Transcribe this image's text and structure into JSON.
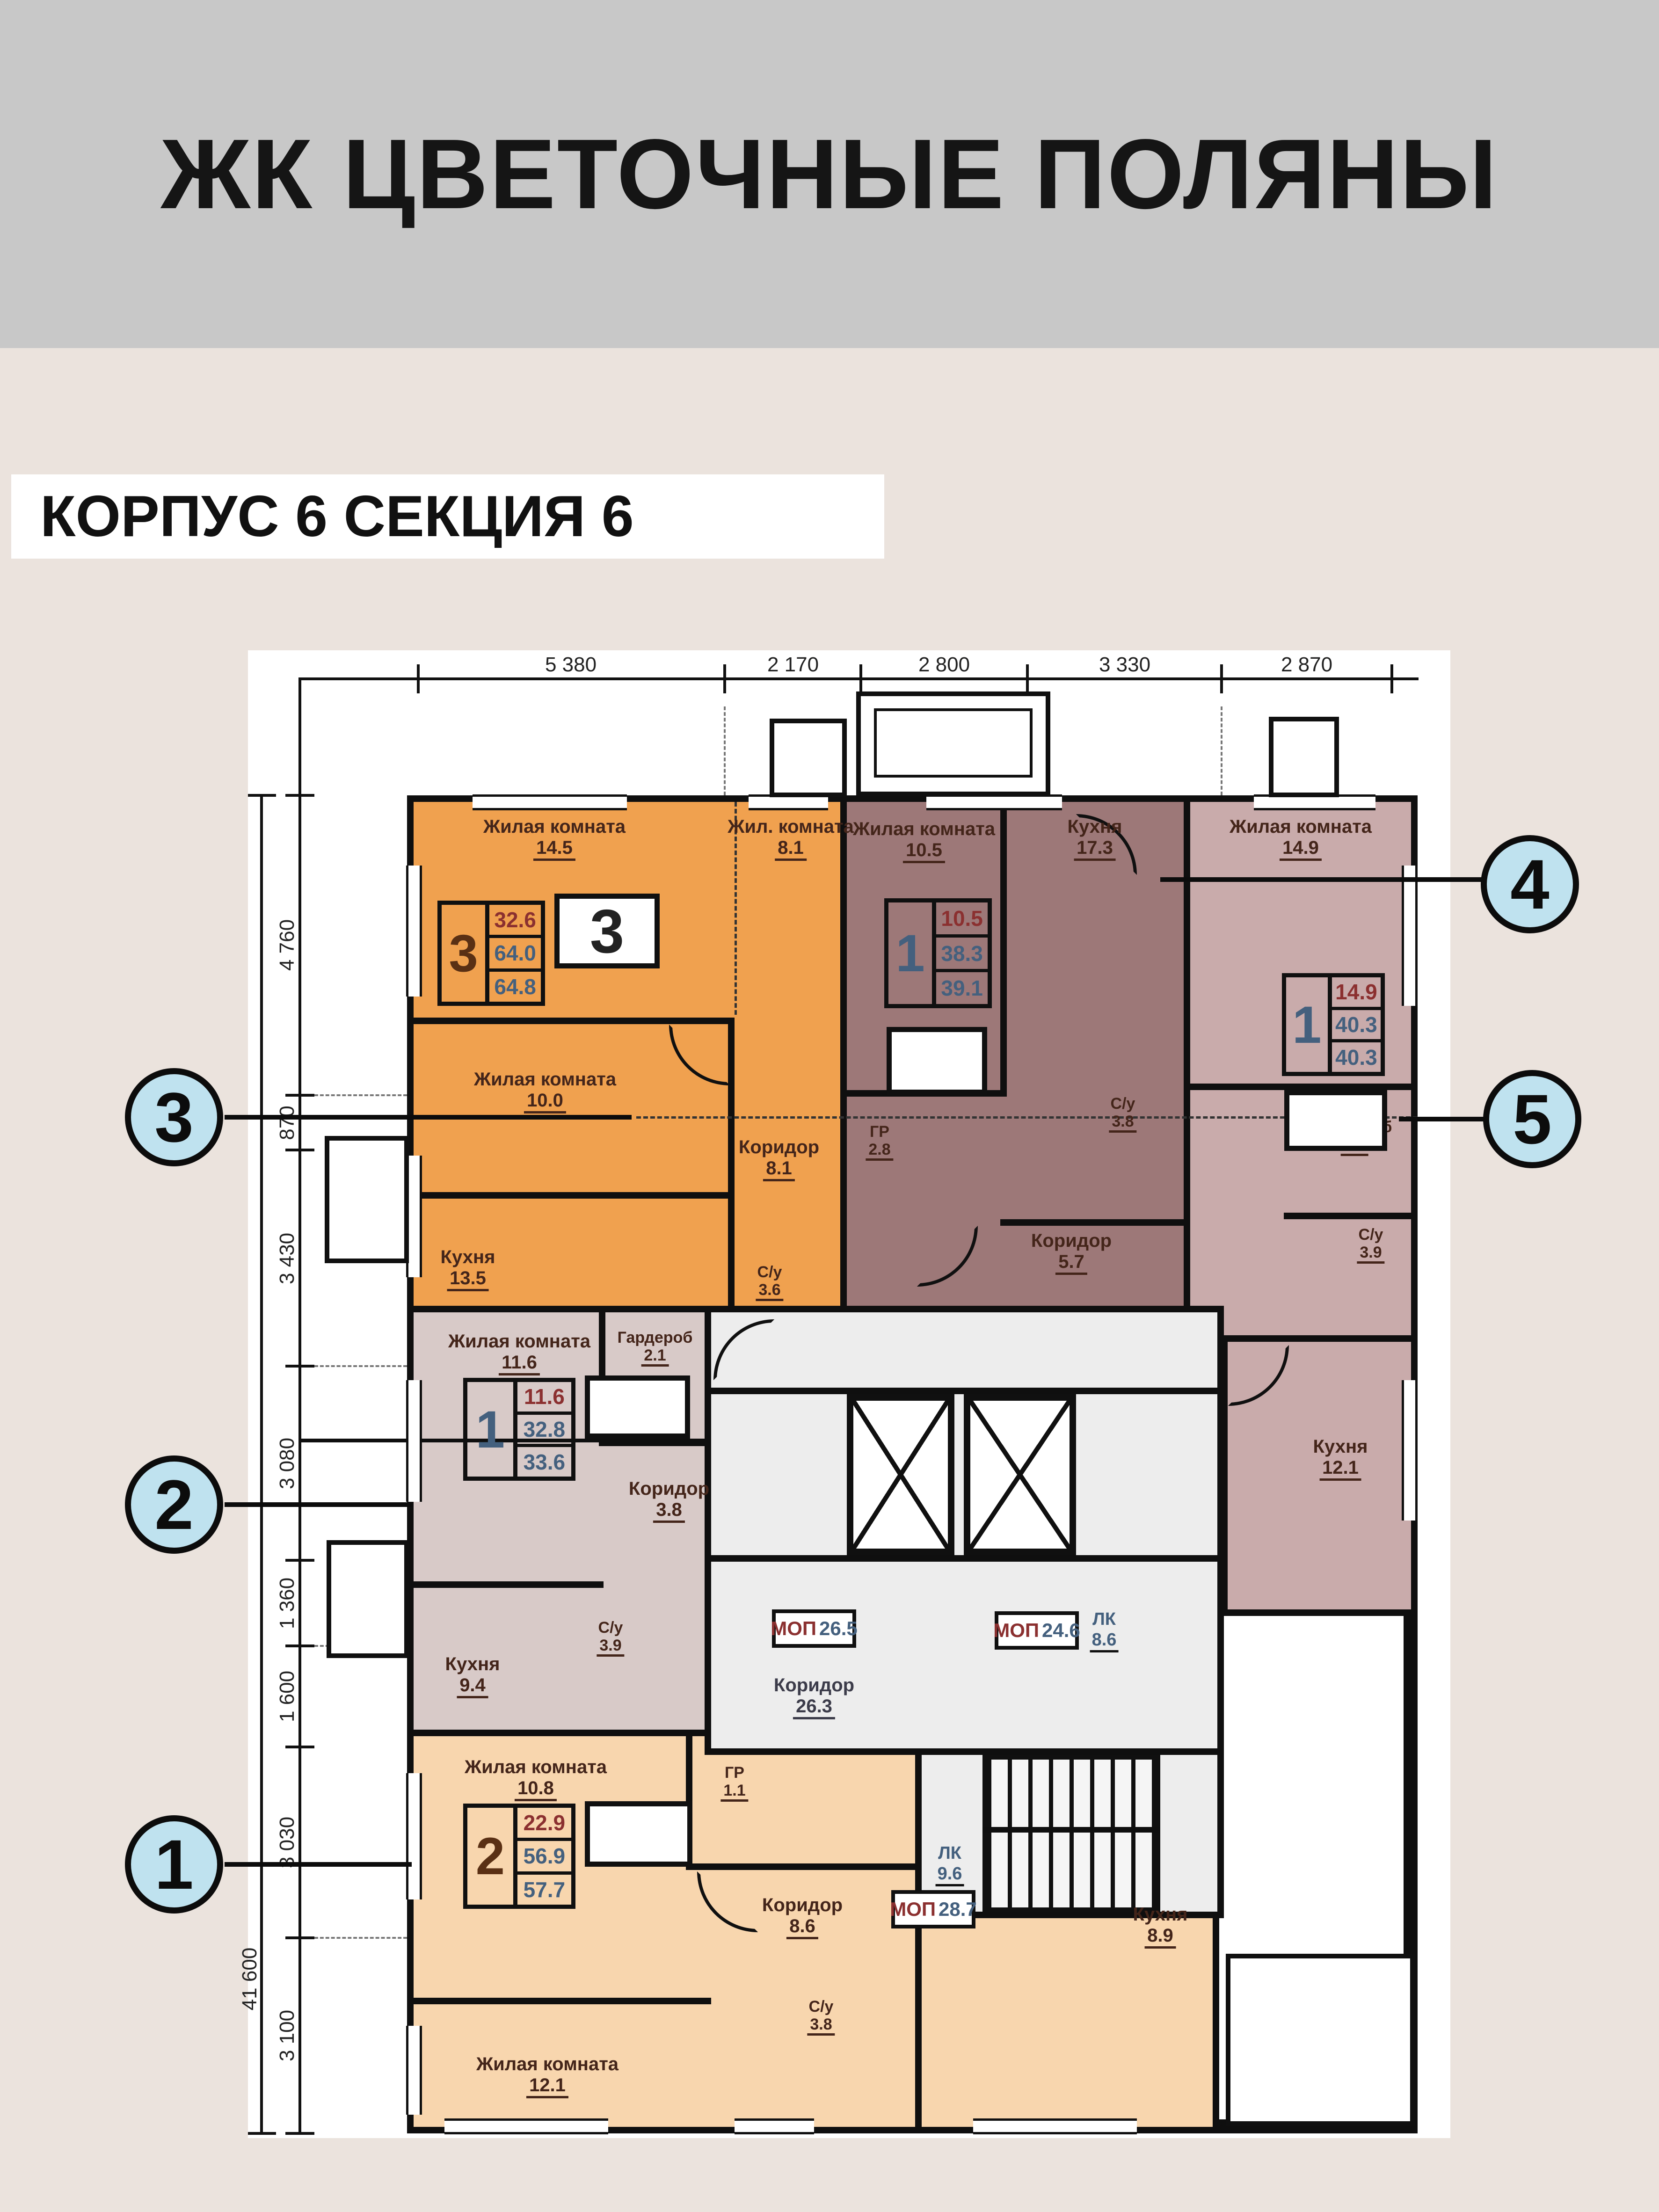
{
  "header": {
    "title": "ЖК ЦВЕТОЧНЫЕ ПОЛЯНЫ",
    "subtitle": "КОРПУС 6 СЕКЦИЯ 6"
  },
  "colors": {
    "header_bg": "#c8c8c8",
    "page_bg": "#ebe3dd",
    "callout_fill": "#bfe2ef",
    "apartment_3": "#f0a14f",
    "apartment_4": "#9d7878",
    "apartment_5": "#c9abab",
    "apartment_2": "#d8cac8",
    "apartment_1": "#f8d6ae",
    "common_area": "#ededed"
  },
  "callouts": [
    "1",
    "2",
    "3",
    "4",
    "5"
  ],
  "apartments": [
    {
      "callout": "3",
      "rooms_count": "3",
      "plate_number": "3",
      "areas": {
        "living": "32.6",
        "area": "64.0",
        "total": "64.8"
      },
      "rooms": [
        {
          "name": "Жилая комната",
          "area": "14.5"
        },
        {
          "name": "Жил. комната",
          "area": "8.1"
        },
        {
          "name": "Жилая комната",
          "area": "10.0"
        },
        {
          "name": "Кухня",
          "area": "13.5"
        },
        {
          "name": "Коридор",
          "area": "8.1"
        },
        {
          "name": "С/у",
          "area": "3.6"
        }
      ]
    },
    {
      "callout": "4",
      "rooms_count": "1",
      "plate_number": "",
      "areas": {
        "living": "10.5",
        "area": "38.3",
        "total": "39.1"
      },
      "rooms": [
        {
          "name": "Жилая комната",
          "area": "10.5"
        },
        {
          "name": "Кухня",
          "area": "17.3"
        },
        {
          "name": "ГР",
          "area": "2.8"
        },
        {
          "name": "Коридор",
          "area": "5.7"
        },
        {
          "name": "С/у",
          "area": "3.8"
        }
      ]
    },
    {
      "callout": "5",
      "rooms_count": "1",
      "plate_number": "",
      "areas": {
        "living": "14.9",
        "area": "40.3",
        "total": "40.3"
      },
      "rooms": [
        {
          "name": "Жилая комната",
          "area": "14.9"
        },
        {
          "name": "Гардероб",
          "area": "1.9"
        },
        {
          "name": "С/у",
          "area": "3.9"
        },
        {
          "name": "Кухня",
          "area": "12.1"
        }
      ]
    },
    {
      "callout": "2",
      "rooms_count": "1",
      "plate_number": "",
      "areas": {
        "living": "11.6",
        "area": "32.8",
        "total": "33.6"
      },
      "rooms": [
        {
          "name": "Жилая комната",
          "area": "11.6"
        },
        {
          "name": "Гардероб",
          "area": "2.1"
        },
        {
          "name": "Коридор",
          "area": "3.8"
        },
        {
          "name": "С/у",
          "area": "3.9"
        },
        {
          "name": "Кухня",
          "area": "9.4"
        }
      ]
    },
    {
      "callout": "1",
      "rooms_count": "2",
      "plate_number": "",
      "areas": {
        "living": "22.9",
        "area": "56.9",
        "total": "57.7"
      },
      "rooms": [
        {
          "name": "Жилая комната",
          "area": "10.8"
        },
        {
          "name": "ГР",
          "area": "1.1"
        },
        {
          "name": "Коридор",
          "area": "8.6"
        },
        {
          "name": "С/у",
          "area": "3.8"
        },
        {
          "name": "Кухня",
          "area": "8.9"
        },
        {
          "name": "Жилая комната",
          "area": "12.1"
        }
      ]
    }
  ],
  "common_areas": {
    "mop_left": {
      "label": "МОП",
      "area": "26.5"
    },
    "corridor": {
      "label": "Коридор",
      "area": "26.3"
    },
    "mop_right": {
      "label": "МОП",
      "area": "24.6"
    },
    "stair_upper": {
      "label": "ЛК",
      "area": "8.6"
    },
    "stair_lower": {
      "label": "ЛК",
      "area": "9.6"
    },
    "mop_lower": {
      "label": "МОП",
      "area": "28.7"
    }
  },
  "dimensions": {
    "top": [
      "5 380",
      "2 170",
      "2 800",
      "3 330",
      "2 870"
    ],
    "left": [
      "4 760",
      "870",
      "3 430",
      "3 080",
      "1 360",
      "1 600",
      "3 030",
      "3 100"
    ],
    "total_left": "41 600"
  }
}
